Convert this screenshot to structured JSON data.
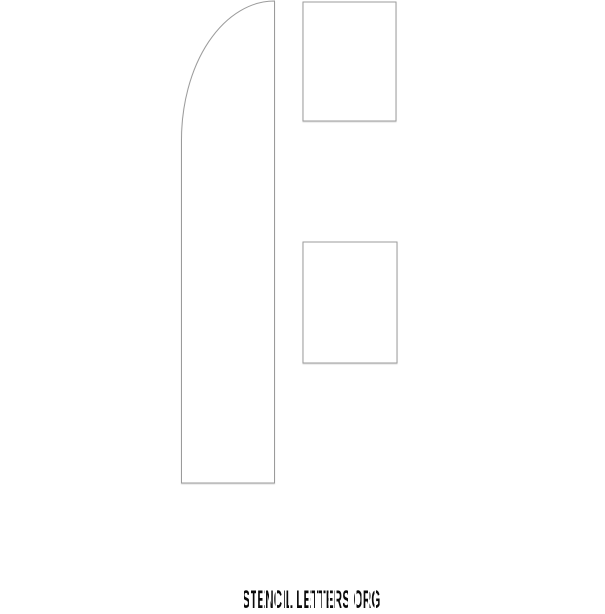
{
  "page": {
    "background_color": "#ffffff"
  },
  "stencil": {
    "letter": "F",
    "outline_color": "#9b9b9b",
    "fill_color": "#ffffff",
    "stem_path": "M274.5,1 L274.5,483 L181.5,483 L181.5,140 A93,139 0 0 1 274.5,1 Z",
    "top_arm": {
      "x": 303,
      "y": 2,
      "width": 93,
      "height": 119
    },
    "middle_arm": {
      "x": 303,
      "y": 242,
      "width": 94,
      "height": 121
    }
  },
  "footer": {
    "brand_text": "STENCIL LETTERS ORG",
    "text_color": "#0a0a0a"
  }
}
